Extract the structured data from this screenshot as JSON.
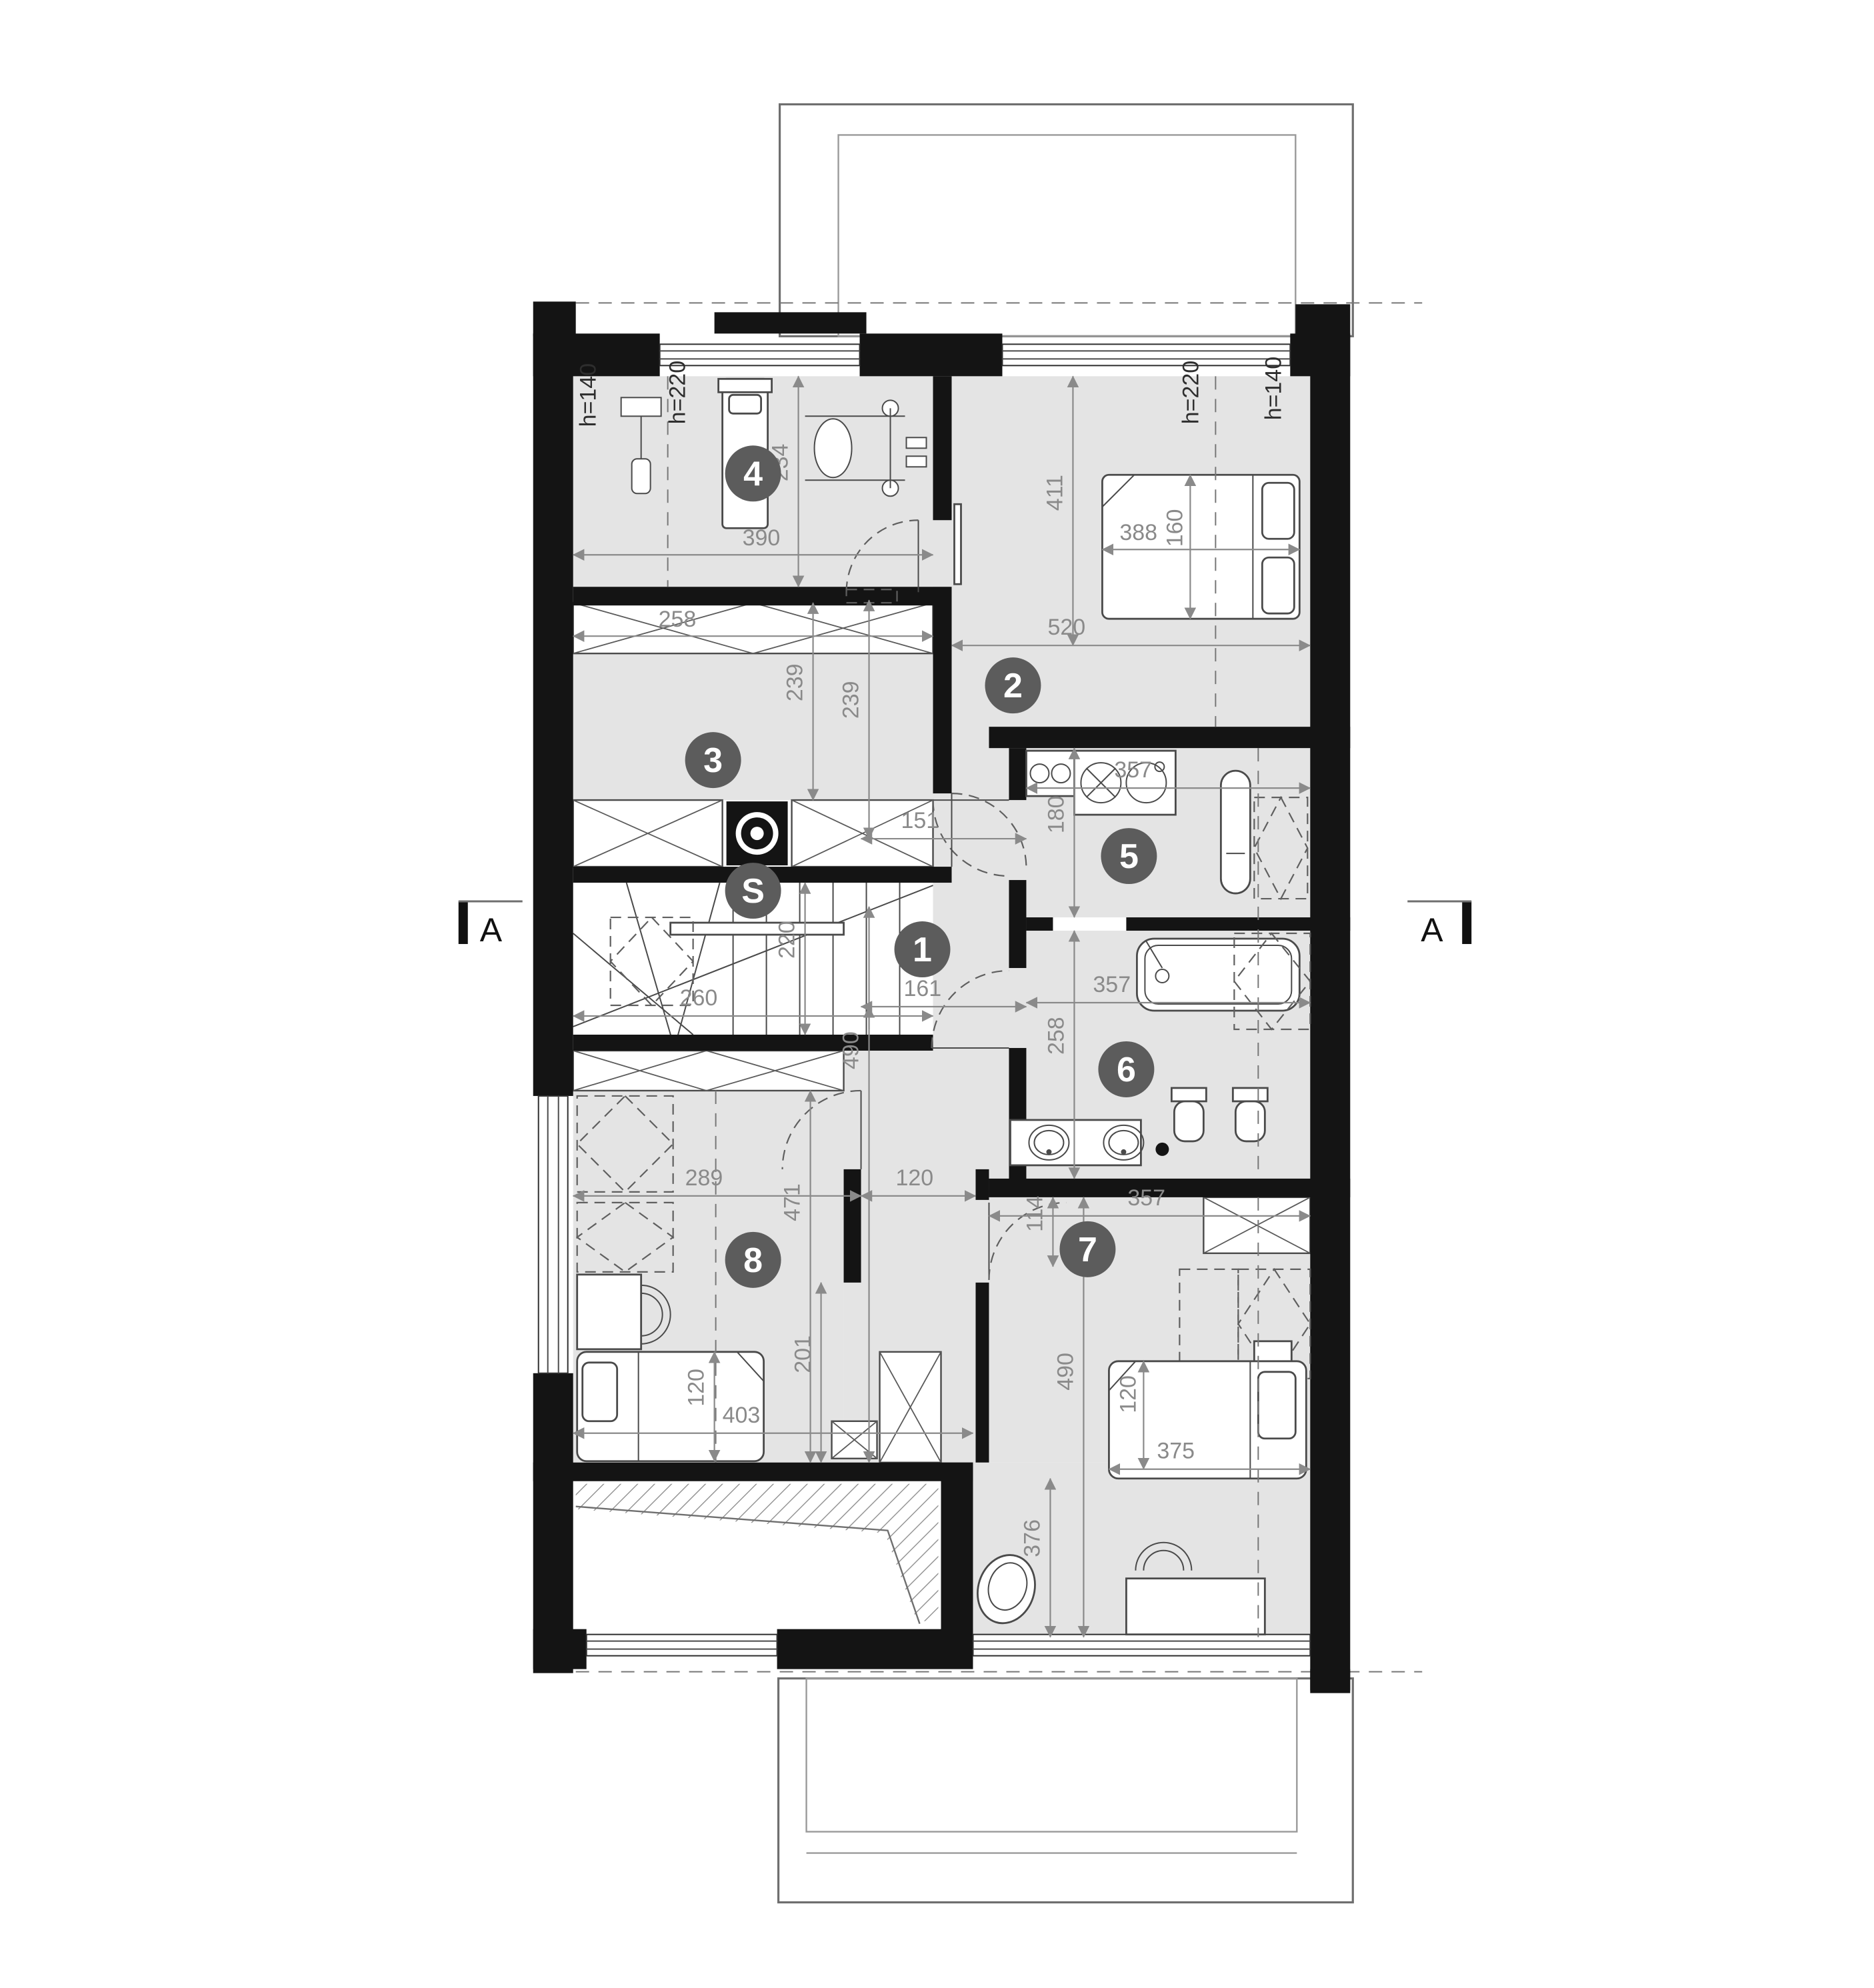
{
  "plan": {
    "type": "architectural-floor-plan",
    "section_label": "A",
    "rooms": [
      {
        "number": "1",
        "name": "hall",
        "dims_cm": [
          "161",
          "490",
          "151",
          "120",
          "239"
        ]
      },
      {
        "number": "2",
        "name": "bedroom",
        "dims_cm": [
          "520",
          "411",
          "388",
          "160"
        ],
        "heights": [
          "h=220",
          "h=140"
        ]
      },
      {
        "number": "3",
        "name": "wardrobe",
        "dims_cm": [
          "258",
          "239"
        ]
      },
      {
        "number": "4",
        "name": "room",
        "dims_cm": [
          "390",
          "234"
        ],
        "heights": [
          "h=140",
          "h=220"
        ]
      },
      {
        "number": "5",
        "name": "laundry-kitchenette",
        "dims_cm": [
          "357",
          "180"
        ]
      },
      {
        "number": "6",
        "name": "bathroom",
        "dims_cm": [
          "357",
          "258"
        ]
      },
      {
        "number": "7",
        "name": "bedroom",
        "dims_cm": [
          "357",
          "114",
          "490",
          "375",
          "120",
          "376"
        ]
      },
      {
        "number": "8",
        "name": "bedroom",
        "dims_cm": [
          "289",
          "471",
          "403",
          "120",
          "201"
        ]
      },
      {
        "number": "S",
        "name": "staircase",
        "dims_cm": [
          "260",
          "220"
        ]
      }
    ],
    "colors": {
      "wall": "#141414",
      "floor": "#e4e4e4",
      "badge": "#5c5c5c",
      "dimension": "#8a8a8a"
    }
  },
  "t": {
    "a": "A",
    "b1": "1",
    "b2": "2",
    "b3": "3",
    "b4": "4",
    "b5": "5",
    "b6": "6",
    "b7": "7",
    "b8": "8",
    "bS": "S",
    "h140": "h=140",
    "h220": "h=220",
    "d114": "114",
    "d120": "120",
    "d151": "151",
    "d160": "160",
    "d161": "161",
    "d180": "180",
    "d201": "201",
    "d220": "220",
    "d234": "234",
    "d239": "239",
    "d258": "258",
    "d260": "260",
    "d289": "289",
    "d357": "357",
    "d375": "375",
    "d376": "376",
    "d388": "388",
    "d390": "390",
    "d403": "403",
    "d411": "411",
    "d471": "471",
    "d490": "490",
    "d520": "520"
  }
}
